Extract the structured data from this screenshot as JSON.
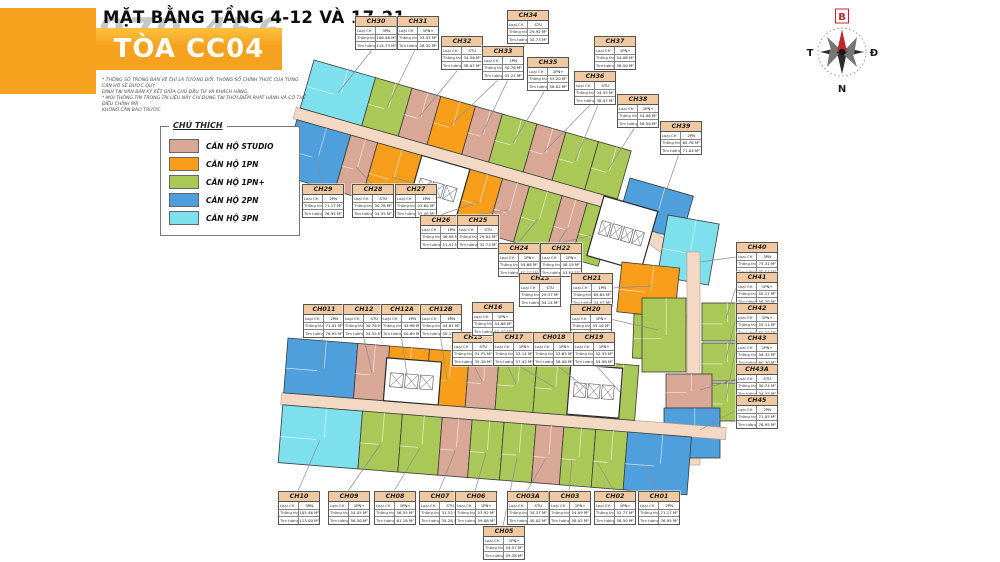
{
  "header": {
    "title": "MẶT BẰNG TẦNG 4-12 VÀ 17-21",
    "tower_banner": "TÒA CC04",
    "watermark": "970.456",
    "disclaimer_lines": [
      "* THÔNG SỐ TRONG BẢN VẼ CHỈ LÀ TƯƠNG ĐỐI, THÔNG SỐ CHÍNH THỨC CỦA TỪNG CĂN HỘ SẼ ĐƯỢC QUY",
      "ĐỊNH TẠI VĂN BẢN KÝ KẾT GIỮA CHỦ ĐẦU TƯ VÀ KHÁCH HÀNG.",
      "* MỌI THÔNG TIN TRONG TÀI LIỆU NÀY CHỈ ĐÚNG TẠI THỜI ĐIỂM PHÁT HÀNH VÀ CÓ THỂ ĐIỀU CHỈNH MÀ",
      "KHÔNG CẦN BÁO TRƯỚC."
    ]
  },
  "legend": {
    "title": "CHÚ THÍCH",
    "items": [
      {
        "label": "CĂN HỘ STUDIO",
        "type": "STU"
      },
      {
        "label": "CĂN HỘ 1PN",
        "type": "1PN"
      },
      {
        "label": "CĂN HỘ 1PN+",
        "type": "1PN+"
      },
      {
        "label": "CĂN HỘ 2PN",
        "type": "2PN"
      },
      {
        "label": "CĂN HỘ 3PN",
        "type": "3PN"
      }
    ]
  },
  "compass": {
    "north": "B",
    "east": "Đ",
    "south": "N",
    "west": "T"
  },
  "unit_table": {
    "row_labels": [
      "Loại CH",
      "Thông thủy",
      "Tim tường"
    ]
  },
  "units": [
    {
      "id": "CH30",
      "type": "3PN",
      "thong_thuy": "106.48 M²",
      "tim_tuong": "114.73 M²"
    },
    {
      "id": "CH31",
      "type": "1PN+",
      "thong_thuy": "53.55 M²",
      "tim_tuong": "58.32 M²"
    },
    {
      "id": "CH32",
      "type": "STU",
      "thong_thuy": "34.50 M²",
      "tim_tuong": "38.07 M²"
    },
    {
      "id": "CH33",
      "type": "1PN",
      "thong_thuy": "50.76 M²",
      "tim_tuong": "55.27 M²"
    },
    {
      "id": "CH34",
      "type": "STU",
      "thong_thuy": "29.92 M²",
      "tim_tuong": "32.73 M²"
    },
    {
      "id": "CH35",
      "type": "1PN+",
      "thong_thuy": "53.20 M²",
      "tim_tuong": "58.02 M²"
    },
    {
      "id": "CH36",
      "type": "STU",
      "thong_thuy": "34.55 M²",
      "tim_tuong": "38.47 M²"
    },
    {
      "id": "CH37",
      "type": "1PN+",
      "thong_thuy": "54.06 M²",
      "tim_tuong": "58.50 M²"
    },
    {
      "id": "CH38",
      "type": "1PN+",
      "thong_thuy": "54.06 M²",
      "tim_tuong": "58.50 M²"
    },
    {
      "id": "CH39",
      "type": "2PN",
      "thong_thuy": "65.76 M²",
      "tim_tuong": "71.04 M²"
    },
    {
      "id": "CH29",
      "type": "2PN",
      "thong_thuy": "71.17 M²",
      "tim_tuong": "76.95 M²"
    },
    {
      "id": "CH28",
      "type": "STU",
      "thong_thuy": "30.76 M²",
      "tim_tuong": "34.55 M²"
    },
    {
      "id": "CH27",
      "type": "1PN",
      "thong_thuy": "53.60 M²",
      "tim_tuong": "55.48 M²"
    },
    {
      "id": "CH26",
      "type": "1PN",
      "thong_thuy": "46.98 M²",
      "tim_tuong": "51.41 M²"
    },
    {
      "id": "CH25",
      "type": "STU",
      "thong_thuy": "29.04 M²",
      "tim_tuong": "32.73 M²"
    },
    {
      "id": "CH24",
      "type": "1PN+",
      "thong_thuy": "54.68 M²",
      "tim_tuong": "58.07 M²"
    },
    {
      "id": "CH23",
      "type": "STU",
      "thong_thuy": "29.37 M²",
      "tim_tuong": "34.14 M²"
    },
    {
      "id": "CH22",
      "type": "1PN+",
      "thong_thuy": "48.19 M²",
      "tim_tuong": "53.66 M²"
    },
    {
      "id": "CH21",
      "type": "1PN",
      "thong_thuy": "69.84 M²",
      "tim_tuong": "74.02 M²"
    },
    {
      "id": "CH20",
      "type": "1PN+",
      "thong_thuy": "55.16 M²",
      "tim_tuong": "60.30 M²"
    },
    {
      "id": "CH011",
      "type": "2PN",
      "thong_thuy": "71.01 M²",
      "tim_tuong": "76.95 M²"
    },
    {
      "id": "CH12",
      "type": "STU",
      "thong_thuy": "30.76 M²",
      "tim_tuong": "34.55 M²"
    },
    {
      "id": "CH12A",
      "type": "1PN",
      "thong_thuy": "45.96 M²",
      "tim_tuong": "50.69 M²"
    },
    {
      "id": "CH12B",
      "type": "1PN",
      "thong_thuy": "44.81 M²",
      "tim_tuong": "50.15 M²"
    },
    {
      "id": "CH15",
      "type": "STU",
      "thong_thuy": "31.75 M²",
      "tim_tuong": "35.30 M²"
    },
    {
      "id": "CH16",
      "type": "1PN+",
      "thong_thuy": "54.68 M²",
      "tim_tuong": "59.08 M²"
    },
    {
      "id": "CH17",
      "type": "1PN+",
      "thong_thuy": "53.14 M²",
      "tim_tuong": "57.45 M²"
    },
    {
      "id": "CH018",
      "type": "1PN+",
      "thong_thuy": "53.65 M²",
      "tim_tuong": "58.08 M²"
    },
    {
      "id": "CH19",
      "type": "1PN+",
      "thong_thuy": "52.55 M²",
      "tim_tuong": "54.90 M²"
    },
    {
      "id": "CH40",
      "type": "3PN",
      "thong_thuy": "75.31 M²",
      "tim_tuong": "85.54 M²"
    },
    {
      "id": "CH41",
      "type": "1PN+",
      "thong_thuy": "52.17 M²",
      "tim_tuong": "56.70 M²"
    },
    {
      "id": "CH42",
      "type": "1PN+",
      "thong_thuy": "55.11 M²",
      "tim_tuong": "60.30 M²"
    },
    {
      "id": "CH43",
      "type": "1PN+",
      "thong_thuy": "58.35 M²",
      "tim_tuong": "60.30 M²"
    },
    {
      "id": "CH43A",
      "type": "STU",
      "thong_thuy": "30.74 M²",
      "tim_tuong": "34.55 M²"
    },
    {
      "id": "CH45",
      "type": "2PN",
      "thong_thuy": "71.05 M²",
      "tim_tuong": "76.95 M²"
    },
    {
      "id": "CH10",
      "type": "3PN",
      "thong_thuy": "105.46 M²",
      "tim_tuong": "113.00 M²"
    },
    {
      "id": "CH09",
      "type": "1PN+",
      "thong_thuy": "54.05 M²",
      "tim_tuong": "58.50 M²"
    },
    {
      "id": "CH08",
      "type": "1PN+",
      "thong_thuy": "56.55 M²",
      "tim_tuong": "61.18 M²"
    },
    {
      "id": "CH07",
      "type": "STU",
      "thong_thuy": "31.53 M²",
      "tim_tuong": "35.28 M²"
    },
    {
      "id": "CH06",
      "type": "1PN+",
      "thong_thuy": "53.92 M²",
      "tim_tuong": "59.08 M²"
    },
    {
      "id": "CH05",
      "type": "1PN+",
      "thong_thuy": "54.57 M²",
      "tim_tuong": "59.38 M²"
    },
    {
      "id": "CH03A",
      "type": "STU",
      "thong_thuy": "34.37 M²",
      "tim_tuong": "40.02 M²"
    },
    {
      "id": "CH03",
      "type": "1PN+",
      "thong_thuy": "54.09 M²",
      "tim_tuong": "58.05 M²"
    },
    {
      "id": "CH02",
      "type": "1PN+",
      "thong_thuy": "52.77 M²",
      "tim_tuong": "58.50 M²"
    },
    {
      "id": "CH01",
      "type": "2PN",
      "thong_thuy": "71.17 M²",
      "tim_tuong": "76.95 M²"
    }
  ],
  "colors": {
    "studio": "#D8A795",
    "pn1": "#F89E1B",
    "pn1_plus": "#A9C857",
    "pn2": "#4E9FDB",
    "pn3": "#7DE0EC",
    "corridor": "#F3D9C3",
    "banner": "#F6A21E",
    "label_header": "#EFC9A2",
    "core": "#FFFFFF"
  }
}
